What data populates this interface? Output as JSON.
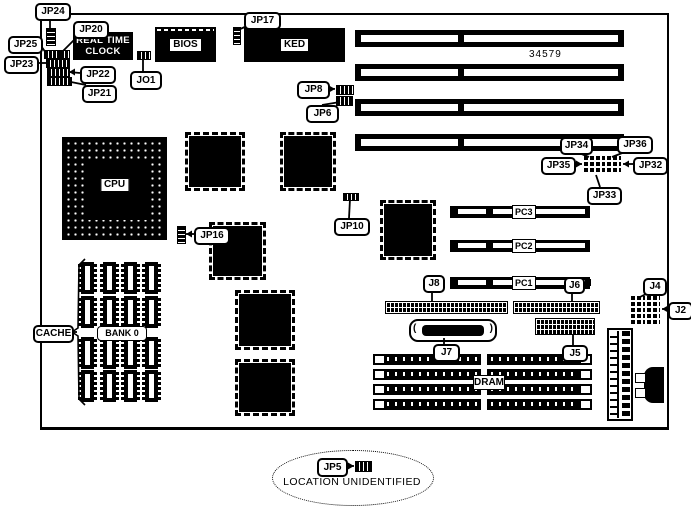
{
  "components": {
    "cpu": "CPU",
    "bios": "BIOS",
    "kbd": "KED",
    "rtc_line1": "REAL TIME",
    "rtc_line2": "CLOCK",
    "bank": "BANK 0",
    "dram": "DRAM",
    "pc1": "PC1",
    "pc2": "PC2",
    "pc3": "PC3",
    "part_number": "34579",
    "note": "LOCATION UNIDENTIFIED"
  },
  "colors": {
    "ink": "#000000",
    "paper": "#ffffff"
  },
  "callouts": [
    {
      "id": "jp24",
      "label": "JP24",
      "x": 35,
      "y": 3,
      "w": 32,
      "h": 14,
      "line": [
        [
          50,
          17
        ],
        [
          50,
          29
        ]
      ]
    },
    {
      "id": "jp20",
      "label": "JP20",
      "x": 73,
      "y": 21,
      "w": 32,
      "h": 14,
      "line": [
        [
          79,
          35
        ],
        [
          63,
          51
        ]
      ]
    },
    {
      "id": "jp25",
      "label": "JP25",
      "x": 8,
      "y": 36,
      "w": 31,
      "h": 14,
      "line": [
        [
          39,
          43
        ],
        [
          46,
          53
        ]
      ]
    },
    {
      "id": "jp23",
      "label": "JP23",
      "x": 4,
      "y": 56,
      "w": 31,
      "h": 14,
      "line": [
        [
          35,
          63
        ],
        [
          47,
          63
        ]
      ]
    },
    {
      "id": "jp22",
      "label": "JP22",
      "x": 80,
      "y": 66,
      "w": 32,
      "h": 14,
      "line": [
        [
          80,
          73
        ],
        [
          69,
          72
        ]
      ],
      "arrow": "left"
    },
    {
      "id": "jp21",
      "label": "JP21",
      "x": 82,
      "y": 85,
      "w": 31,
      "h": 14,
      "line": [
        [
          86,
          85
        ],
        [
          71,
          82
        ]
      ]
    },
    {
      "id": "jo1",
      "label": "JO1",
      "x": 130,
      "y": 71,
      "w": 28,
      "h": 15,
      "line": [
        [
          143,
          71
        ],
        [
          143,
          58
        ]
      ]
    },
    {
      "id": "jp17",
      "label": "JP17",
      "x": 244,
      "y": 12,
      "w": 33,
      "h": 14,
      "line": [
        [
          247,
          26
        ],
        [
          238,
          30
        ]
      ]
    },
    {
      "id": "jp8",
      "label": "JP8",
      "x": 297,
      "y": 81,
      "w": 29,
      "h": 14,
      "line": [
        [
          326,
          88
        ],
        [
          335,
          89
        ]
      ],
      "arrow": "right"
    },
    {
      "id": "jp6",
      "label": "JP6",
      "x": 306,
      "y": 105,
      "w": 29,
      "h": 14,
      "line": [
        [
          322,
          105
        ],
        [
          340,
          102
        ]
      ]
    },
    {
      "id": "jp34",
      "label": "JP34",
      "x": 560,
      "y": 137,
      "w": 29,
      "h": 14,
      "line": [
        [
          574,
          151
        ],
        [
          589,
          157
        ]
      ]
    },
    {
      "id": "jp36",
      "label": "JP36",
      "x": 617,
      "y": 136,
      "w": 32,
      "h": 14,
      "line": [
        [
          630,
          150
        ],
        [
          612,
          157
        ]
      ]
    },
    {
      "id": "jp35",
      "label": "JP35",
      "x": 541,
      "y": 157,
      "w": 31,
      "h": 14,
      "line": [
        [
          572,
          164
        ],
        [
          582,
          164
        ]
      ],
      "arrow": "right"
    },
    {
      "id": "jp32",
      "label": "JP32",
      "x": 633,
      "y": 157,
      "w": 31,
      "h": 14,
      "line": [
        [
          633,
          164
        ],
        [
          623,
          164
        ]
      ],
      "arrow": "left"
    },
    {
      "id": "jp33",
      "label": "JP33",
      "x": 587,
      "y": 187,
      "w": 31,
      "h": 14,
      "line": [
        [
          600,
          187
        ],
        [
          596,
          175
        ]
      ]
    },
    {
      "id": "jp10",
      "label": "JP10",
      "x": 334,
      "y": 218,
      "w": 32,
      "h": 14,
      "line": [
        [
          349,
          218
        ],
        [
          350,
          199
        ]
      ]
    },
    {
      "id": "jp16",
      "label": "JP16",
      "x": 194,
      "y": 227,
      "w": 32,
      "h": 14,
      "line": [
        [
          194,
          234
        ],
        [
          186,
          234
        ]
      ],
      "arrow": "left"
    },
    {
      "id": "j8",
      "label": "J8",
      "x": 423,
      "y": 275,
      "w": 18,
      "h": 14,
      "line": [
        [
          432,
          289
        ],
        [
          432,
          301
        ]
      ]
    },
    {
      "id": "j6",
      "label": "J6",
      "x": 564,
      "y": 277,
      "w": 17,
      "h": 13,
      "line": [
        [
          572,
          290
        ],
        [
          572,
          301
        ]
      ]
    },
    {
      "id": "j7",
      "label": "J7",
      "x": 433,
      "y": 344,
      "w": 23,
      "h": 14,
      "line": [
        [
          444,
          344
        ],
        [
          444,
          338
        ]
      ]
    },
    {
      "id": "j5",
      "label": "J5",
      "x": 562,
      "y": 345,
      "w": 22,
      "h": 13,
      "line": [
        [
          573,
          345
        ],
        [
          573,
          334
        ]
      ]
    },
    {
      "id": "j4",
      "label": "J4",
      "x": 643,
      "y": 278,
      "w": 20,
      "h": 14,
      "line": [
        [
          650,
          292
        ],
        [
          640,
          297
        ]
      ]
    },
    {
      "id": "j2",
      "label": "J2",
      "x": 668,
      "y": 302,
      "w": 21,
      "h": 14,
      "line": [
        [
          668,
          309
        ],
        [
          662,
          309
        ]
      ],
      "arrow": "left"
    },
    {
      "id": "cache",
      "label": "CACHE",
      "x": 33,
      "y": 325,
      "w": 37,
      "h": 14,
      "line": [
        [
          70,
          332
        ],
        [
          77,
          332
        ]
      ]
    },
    {
      "id": "jp5",
      "label": "JP5",
      "x": 317,
      "y": 458,
      "w": 27,
      "h": 15,
      "line": [
        [
          344,
          466
        ],
        [
          354,
          466
        ]
      ],
      "arrow": "right"
    }
  ]
}
